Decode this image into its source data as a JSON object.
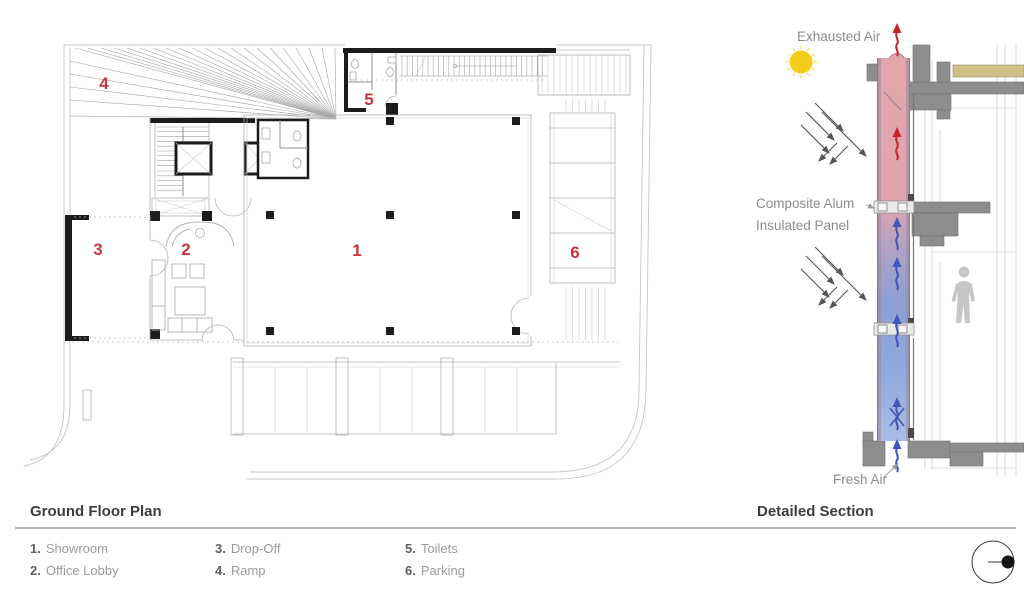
{
  "plan": {
    "title": "Ground Floor Plan",
    "rooms": [
      {
        "num": "1",
        "num_dot": "1.",
        "label": "Showroom"
      },
      {
        "num": "2",
        "num_dot": "2.",
        "label": "Office Lobby"
      },
      {
        "num": "3",
        "num_dot": "3.",
        "label": "Drop-Off"
      },
      {
        "num": "4",
        "num_dot": "4.",
        "label": "Ramp"
      },
      {
        "num": "5",
        "num_dot": "5.",
        "label": "Toilets"
      },
      {
        "num": "6",
        "num_dot": "6.",
        "label": "Parking"
      }
    ]
  },
  "section": {
    "title": "Detailed Section",
    "labels": {
      "exhausted_air": "Exhausted Air",
      "panel_line1": "Composite Alum",
      "panel_line2": "Insulated Panel",
      "fresh_air": "Fresh Air"
    }
  },
  "icons": {
    "sun": "sun-icon",
    "north_marker": "section-cut-marker-icon"
  },
  "colors": {
    "room_number": "#c8333c",
    "annotation": "#8c8c8c",
    "title": "#3d3d3d",
    "rule": "#b3b3b3",
    "sun": "#f4cd1a",
    "arrow_red": "#c5242b",
    "arrow_blue": "#3f57b8",
    "slab": "#8d8d8d",
    "roof_finish": "#cfc08a",
    "warm_air": "#dfa3ac",
    "cool_air": "#8fa6d8"
  }
}
